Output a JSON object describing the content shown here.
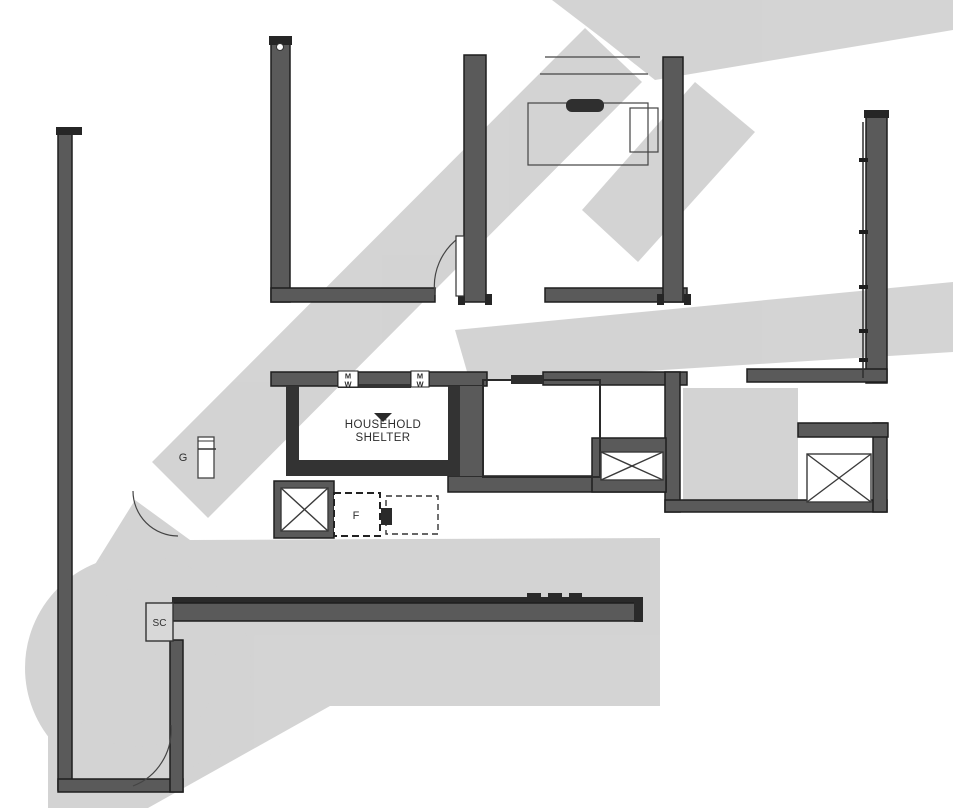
{
  "floorplan": {
    "type": "apartment-floor-plan",
    "labels": {
      "household_shelter_line1": "HOUSEHOLD",
      "household_shelter_line2": "SHELTER",
      "shoe_cabinet": "SC",
      "fridge": "F",
      "gas_hob": "G",
      "meters": [
        {
          "top": "M",
          "bottom": "W"
        },
        {
          "top": "M",
          "bottom": "W"
        }
      ]
    },
    "symbols": {
      "ac_ledge_cross": "x-cross-box",
      "door_swing": "quarter-arc",
      "window_band": "segmented-line"
    },
    "colors": {
      "background": "#ffffff",
      "wall": "#5a5a5a",
      "wall_edge": "#1e1e1e",
      "shelter_wall": "#333333",
      "watermark": "#c9c9c9",
      "fixture_fill": "#ffffff",
      "sc_fill": "#d8d8d8"
    }
  }
}
